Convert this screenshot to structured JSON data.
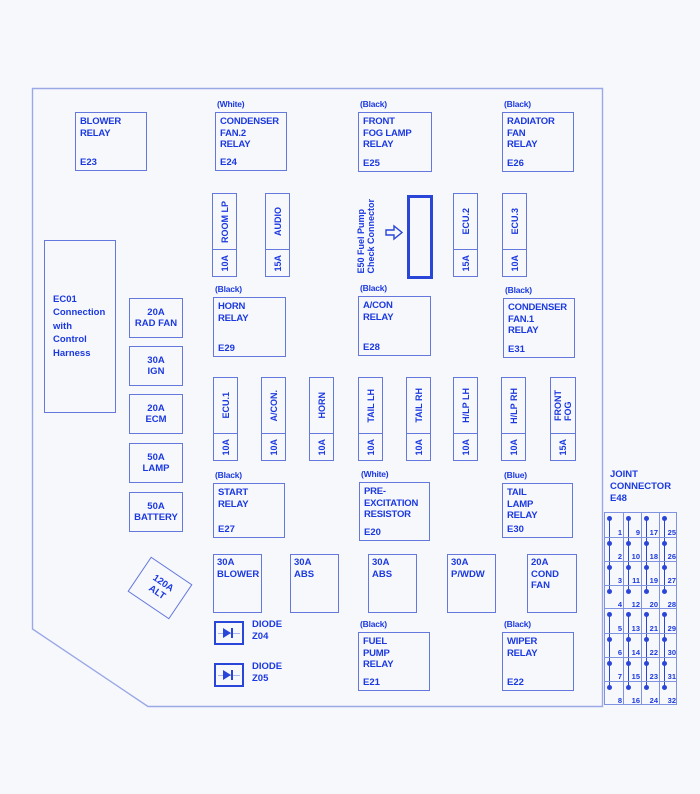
{
  "palette": {
    "background": "#f7f8fc",
    "text_blue": "#1b39e0",
    "box_border": "#6478de",
    "outline_border": "#9aa8e6",
    "thick_border": "#2946d8",
    "grid_border": "#8093e2"
  },
  "relays": [
    {
      "color_label": "",
      "lines": "BLOWER\nRELAY",
      "code": "E23"
    },
    {
      "color_label": "(White)",
      "lines": "CONDENSER\nFAN.2\nRELAY",
      "code": "E24"
    },
    {
      "color_label": "(Black)",
      "lines": "FRONT\nFOG LAMP\nRELAY",
      "code": "E25"
    },
    {
      "color_label": "(Black)",
      "lines": "RADIATOR\nFAN\nRELAY",
      "code": "E26"
    },
    {
      "color_label": "(Black)",
      "lines": "HORN\nRELAY",
      "code": "E29"
    },
    {
      "color_label": "(Black)",
      "lines": "A/CON\nRELAY",
      "code": "E28"
    },
    {
      "color_label": "(Black)",
      "lines": "CONDENSER\nFAN.1\nRELAY",
      "code": "E31"
    },
    {
      "color_label": "(Black)",
      "lines": "START\nRELAY",
      "code": "E27"
    },
    {
      "color_label": "(White)",
      "lines": "PRE-\nEXCITATION\nRESISTOR",
      "code": "E20"
    },
    {
      "color_label": "(Blue)",
      "lines": "TAIL\nLAMP\nRELAY",
      "code": "E30"
    },
    {
      "color_label": "(Black)",
      "lines": "FUEL\nPUMP\nRELAY",
      "code": "E21"
    },
    {
      "color_label": "(Black)",
      "lines": "WIPER\nRELAY",
      "code": "E22"
    }
  ],
  "fuses": [
    {
      "amp": "10A",
      "label": "ROOM LP"
    },
    {
      "amp": "15A",
      "label": "AUDIO"
    },
    {
      "amp": "15A",
      "label": "ECU.2"
    },
    {
      "amp": "10A",
      "label": "ECU.3"
    },
    {
      "amp": "10A",
      "label": "ECU.1"
    },
    {
      "amp": "10A",
      "label": "A/CON."
    },
    {
      "amp": "10A",
      "label": "HORN"
    },
    {
      "amp": "10A",
      "label": "TAIL LH"
    },
    {
      "amp": "10A",
      "label": "TAIL RH"
    },
    {
      "amp": "10A",
      "label": "H/LP LH"
    },
    {
      "amp": "10A",
      "label": "H/LP RH"
    },
    {
      "amp": "15A",
      "label": "FRONT\nFOG"
    }
  ],
  "left_connector": {
    "text": "EC01\nConnection\nwith\nControl\nHarness"
  },
  "left_fuses": [
    {
      "amp": "20A",
      "label": "RAD FAN"
    },
    {
      "amp": "30A",
      "label": "IGN"
    },
    {
      "amp": "20A",
      "label": "ECM"
    },
    {
      "amp": "50A",
      "label": "LAMP"
    },
    {
      "amp": "50A",
      "label": "BATTERY"
    }
  ],
  "amp_fuses": [
    {
      "amp": "30A",
      "label": "BLOWER"
    },
    {
      "amp": "30A",
      "label": "ABS"
    },
    {
      "amp": "30A",
      "label": "ABS"
    },
    {
      "amp": "30A",
      "label": "P/WDW"
    },
    {
      "amp": "20A",
      "label": "COND FAN"
    }
  ],
  "alt_fuse": {
    "amp": "120A",
    "label": "ALT"
  },
  "diodes": [
    {
      "name": "DIODE",
      "code": "Z04"
    },
    {
      "name": "DIODE",
      "code": "Z05"
    }
  ],
  "e50": {
    "text": "E50 Fuel Pump\nCheck Connector"
  },
  "joint_connector": {
    "title": "JOINT\nCONNECTOR\nE48",
    "columns": [
      [
        1,
        2,
        3,
        4,
        5,
        6,
        7,
        8
      ],
      [
        9,
        10,
        11,
        12,
        13,
        14,
        15,
        16
      ],
      [
        17,
        18,
        19,
        20,
        21,
        22,
        23,
        24
      ],
      [
        25,
        26,
        27,
        28,
        29,
        30,
        31,
        32
      ]
    ]
  }
}
